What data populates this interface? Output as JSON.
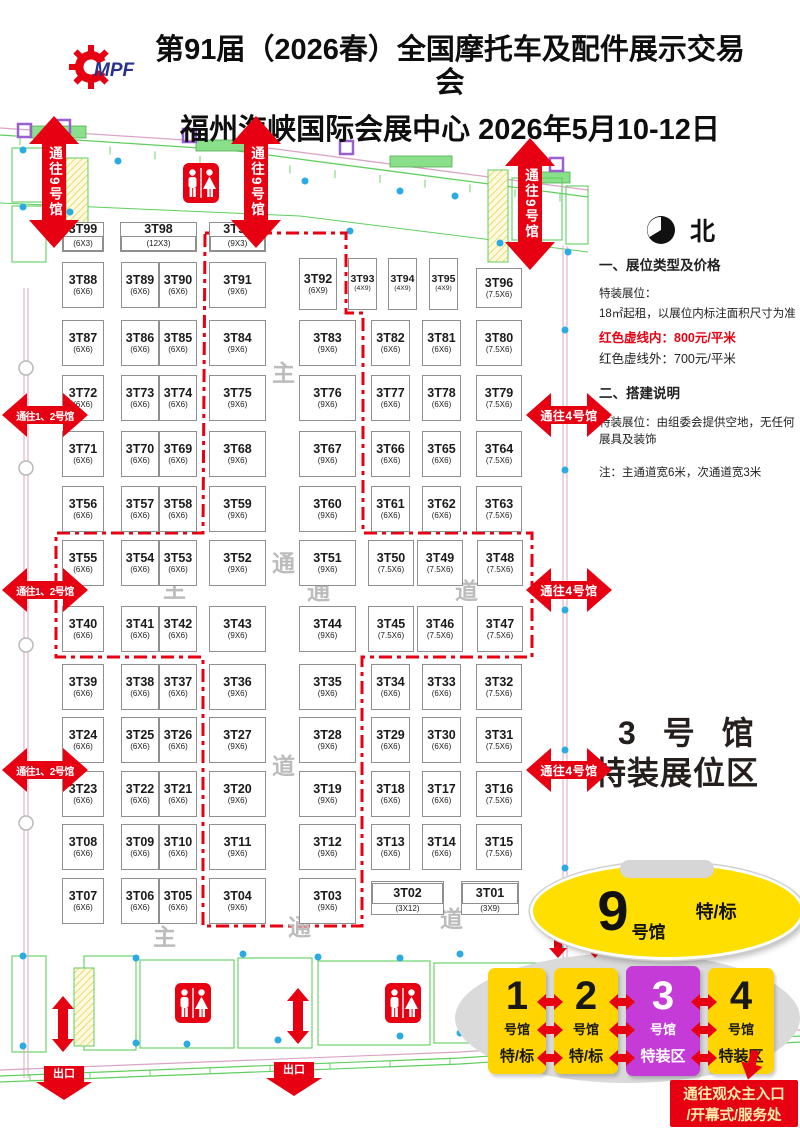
{
  "colors": {
    "red": "#e60012",
    "hall_yellow": "#ffd400",
    "hall_purple": "#c43bd8",
    "ellipse_yellow": "#ffdf00",
    "cad_green": "#5fcf5f",
    "cad_cyan": "#2aabe2",
    "logo_blue": "#28338a"
  },
  "header": {
    "logo_text": "MPF",
    "title_line1": "第91届（2026春）全国摩托车及配件展示交易会",
    "title_line2": "福州海峡国际会展中心  2026年5月10-12日"
  },
  "north": {
    "label": "北"
  },
  "info_panel": {
    "section1": "一、展位类型及价格",
    "l1": "特装展位：",
    "l2": "18㎡起租，以展位内标注面积尺寸为准",
    "l3": "红色虚线内：800元/平米",
    "l4": "红色虚线外：700元/平米",
    "section2": "二、搭建说明",
    "l5": "特装展位：由组委会提供空地，无任何展具及装饰",
    "note": "注：主通道宽6米，次通道宽3米"
  },
  "zone_label": {
    "line1": "3 号 馆",
    "line2": "特装展位区"
  },
  "arrows": {
    "top": {
      "label": "通往9号馆",
      "positions": [
        [
          29,
          116
        ],
        [
          231,
          116
        ],
        [
          505,
          138
        ]
      ]
    },
    "left": {
      "label": "通往1、2号馆",
      "positions": [
        [
          2,
          393
        ],
        [
          2,
          568
        ],
        [
          2,
          748
        ]
      ]
    },
    "right": {
      "label": "通往4号馆",
      "positions": [
        [
          526,
          393
        ],
        [
          526,
          568
        ],
        [
          526,
          748
        ]
      ]
    },
    "exits": {
      "label": "出口",
      "positions": [
        [
          36,
          1066
        ],
        [
          266,
          1062
        ]
      ]
    },
    "plain_vertical": [
      [
        52,
        996
      ],
      [
        287,
        988
      ]
    ]
  },
  "floor": {
    "premium_zone_path": "M205,233 L346,233 L346,313 L363,313 L363,533 L532,533 L532,657 L362,657 L362,926 L203,926 L203,657 L56,657 L56,533 L203,533 Z",
    "aisle_labels": [
      [
        "主",
        272,
        362
      ],
      [
        "通",
        272,
        552
      ],
      [
        "道",
        272,
        755
      ],
      [
        "主",
        163,
        578
      ],
      [
        "通",
        307,
        580
      ],
      [
        "道",
        455,
        580
      ],
      [
        "主",
        153,
        926
      ],
      [
        "通",
        288,
        916
      ],
      [
        "道",
        440,
        908
      ]
    ],
    "booths": [
      [
        "3T99",
        "(6X3)",
        62,
        222,
        42,
        30,
        1
      ],
      [
        "3T98",
        "(12X3)",
        120,
        222,
        77,
        30,
        1
      ],
      [
        "3T97",
        "(9X3)",
        209,
        222,
        57,
        30,
        1
      ],
      [
        "3T88",
        "(6X6)",
        62,
        262,
        42,
        46,
        0
      ],
      [
        "3T89",
        "(6X6)",
        121,
        262,
        38,
        46,
        0
      ],
      [
        "3T90",
        "(6X6)",
        159,
        262,
        38,
        46,
        0
      ],
      [
        "3T91",
        "(9X6)",
        209,
        262,
        57,
        46,
        0
      ],
      [
        "3T92",
        "(6X9)",
        299,
        258,
        38,
        52,
        0
      ],
      [
        "3T93",
        "(4X9)",
        348,
        258,
        29,
        52,
        0
      ],
      [
        "3T94",
        "(4X9)",
        388,
        258,
        29,
        52,
        0
      ],
      [
        "3T95",
        "(4X9)",
        429,
        258,
        29,
        52,
        0
      ],
      [
        "3T96",
        "(7.5X6)",
        476,
        268,
        46,
        40,
        0
      ],
      [
        "3T87",
        "(6X6)",
        62,
        320,
        42,
        46,
        0
      ],
      [
        "3T86",
        "(6X6)",
        121,
        320,
        38,
        46,
        0
      ],
      [
        "3T85",
        "(6X6)",
        159,
        320,
        38,
        46,
        0
      ],
      [
        "3T84",
        "(9X6)",
        209,
        320,
        57,
        46,
        0
      ],
      [
        "3T83",
        "(9X6)",
        299,
        320,
        57,
        46,
        0
      ],
      [
        "3T82",
        "(6X6)",
        371,
        320,
        39,
        46,
        0
      ],
      [
        "3T81",
        "(6X6)",
        422,
        320,
        39,
        46,
        0
      ],
      [
        "3T80",
        "(7.5X6)",
        476,
        320,
        46,
        46,
        0
      ],
      [
        "3T72",
        "(6X6)",
        62,
        375,
        42,
        46,
        0
      ],
      [
        "3T73",
        "(6X6)",
        121,
        375,
        38,
        46,
        0
      ],
      [
        "3T74",
        "(6X6)",
        159,
        375,
        38,
        46,
        0
      ],
      [
        "3T75",
        "(9X6)",
        209,
        375,
        57,
        46,
        0
      ],
      [
        "3T76",
        "(9X6)",
        299,
        375,
        57,
        46,
        0
      ],
      [
        "3T77",
        "(6X6)",
        371,
        375,
        39,
        46,
        0
      ],
      [
        "3T78",
        "(6X6)",
        422,
        375,
        39,
        46,
        0
      ],
      [
        "3T79",
        "(7.5X6)",
        476,
        375,
        46,
        46,
        0
      ],
      [
        "3T71",
        "(6X6)",
        62,
        431,
        42,
        46,
        0
      ],
      [
        "3T70",
        "(6X6)",
        121,
        431,
        38,
        46,
        0
      ],
      [
        "3T69",
        "(6X6)",
        159,
        431,
        38,
        46,
        0
      ],
      [
        "3T68",
        "(9X6)",
        209,
        431,
        57,
        46,
        0
      ],
      [
        "3T67",
        "(9X6)",
        299,
        431,
        57,
        46,
        0
      ],
      [
        "3T66",
        "(6X6)",
        371,
        431,
        39,
        46,
        0
      ],
      [
        "3T65",
        "(6X6)",
        422,
        431,
        39,
        46,
        0
      ],
      [
        "3T64",
        "(7.5X6)",
        476,
        431,
        46,
        46,
        0
      ],
      [
        "3T56",
        "(6X6)",
        62,
        486,
        42,
        46,
        0
      ],
      [
        "3T57",
        "(6X6)",
        121,
        486,
        38,
        46,
        0
      ],
      [
        "3T58",
        "(6X6)",
        159,
        486,
        38,
        46,
        0
      ],
      [
        "3T59",
        "(9X6)",
        209,
        486,
        57,
        46,
        0
      ],
      [
        "3T60",
        "(9X6)",
        299,
        486,
        57,
        46,
        0
      ],
      [
        "3T61",
        "(6X6)",
        371,
        486,
        39,
        46,
        0
      ],
      [
        "3T62",
        "(6X6)",
        422,
        486,
        39,
        46,
        0
      ],
      [
        "3T63",
        "(7.5X6)",
        476,
        486,
        46,
        46,
        0
      ],
      [
        "3T55",
        "(6X6)",
        62,
        540,
        42,
        46,
        0
      ],
      [
        "3T54",
        "(6X6)",
        121,
        540,
        38,
        46,
        0
      ],
      [
        "3T53",
        "(6X6)",
        159,
        540,
        38,
        46,
        0
      ],
      [
        "3T52",
        "(9X6)",
        209,
        540,
        57,
        46,
        0
      ],
      [
        "3T51",
        "(9X6)",
        299,
        540,
        57,
        46,
        0
      ],
      [
        "3T50",
        "(7.5X6)",
        368,
        540,
        46,
        46,
        0
      ],
      [
        "3T49",
        "(7.5X6)",
        417,
        540,
        46,
        46,
        0
      ],
      [
        "3T48",
        "(7.5X6)",
        477,
        540,
        46,
        46,
        0
      ],
      [
        "3T40",
        "(6X6)",
        62,
        606,
        42,
        46,
        0
      ],
      [
        "3T41",
        "(6X6)",
        121,
        606,
        38,
        46,
        0
      ],
      [
        "3T42",
        "(6X6)",
        159,
        606,
        38,
        46,
        0
      ],
      [
        "3T43",
        "(9X6)",
        209,
        606,
        57,
        46,
        0
      ],
      [
        "3T44",
        "(9X6)",
        299,
        606,
        57,
        46,
        0
      ],
      [
        "3T45",
        "(7.5X6)",
        368,
        606,
        46,
        46,
        0
      ],
      [
        "3T46",
        "(7.5X6)",
        417,
        606,
        46,
        46,
        0
      ],
      [
        "3T47",
        "(7.5X6)",
        477,
        606,
        46,
        46,
        0
      ],
      [
        "3T39",
        "(6X6)",
        62,
        664,
        42,
        46,
        0
      ],
      [
        "3T38",
        "(6X6)",
        121,
        664,
        38,
        46,
        0
      ],
      [
        "3T37",
        "(6X6)",
        159,
        664,
        38,
        46,
        0
      ],
      [
        "3T36",
        "(9X6)",
        209,
        664,
        57,
        46,
        0
      ],
      [
        "3T35",
        "(9X6)",
        299,
        664,
        57,
        46,
        0
      ],
      [
        "3T34",
        "(6X6)",
        371,
        664,
        39,
        46,
        0
      ],
      [
        "3T33",
        "(6X6)",
        422,
        664,
        39,
        46,
        0
      ],
      [
        "3T32",
        "(7.5X6)",
        476,
        664,
        46,
        46,
        0
      ],
      [
        "3T24",
        "(6X6)",
        62,
        717,
        42,
        46,
        0
      ],
      [
        "3T25",
        "(6X6)",
        121,
        717,
        38,
        46,
        0
      ],
      [
        "3T26",
        "(6X6)",
        159,
        717,
        38,
        46,
        0
      ],
      [
        "3T27",
        "(9X6)",
        209,
        717,
        57,
        46,
        0
      ],
      [
        "3T28",
        "(9X6)",
        299,
        717,
        57,
        46,
        0
      ],
      [
        "3T29",
        "(6X6)",
        371,
        717,
        39,
        46,
        0
      ],
      [
        "3T30",
        "(6X6)",
        422,
        717,
        39,
        46,
        0
      ],
      [
        "3T31",
        "(7.5X6)",
        476,
        717,
        46,
        46,
        0
      ],
      [
        "3T23",
        "(6X6)",
        62,
        771,
        42,
        46,
        0
      ],
      [
        "3T22",
        "(6X6)",
        121,
        771,
        38,
        46,
        0
      ],
      [
        "3T21",
        "(6X6)",
        159,
        771,
        38,
        46,
        0
      ],
      [
        "3T20",
        "(9X6)",
        209,
        771,
        57,
        46,
        0
      ],
      [
        "3T19",
        "(9X6)",
        299,
        771,
        57,
        46,
        0
      ],
      [
        "3T18",
        "(6X6)",
        371,
        771,
        39,
        46,
        0
      ],
      [
        "3T17",
        "(6X6)",
        422,
        771,
        39,
        46,
        0
      ],
      [
        "3T16",
        "(7.5X6)",
        476,
        771,
        46,
        46,
        0
      ],
      [
        "3T08",
        "(6X6)",
        62,
        824,
        42,
        46,
        0
      ],
      [
        "3T09",
        "(6X6)",
        121,
        824,
        38,
        46,
        0
      ],
      [
        "3T10",
        "(6X6)",
        159,
        824,
        38,
        46,
        0
      ],
      [
        "3T11",
        "(9X6)",
        209,
        824,
        57,
        46,
        0
      ],
      [
        "3T12",
        "(9X6)",
        299,
        824,
        57,
        46,
        0
      ],
      [
        "3T13",
        "(6X6)",
        371,
        824,
        39,
        46,
        0
      ],
      [
        "3T14",
        "(6X6)",
        422,
        824,
        39,
        46,
        0
      ],
      [
        "3T15",
        "(7.5X6)",
        476,
        824,
        46,
        46,
        0
      ],
      [
        "3T07",
        "(6X6)",
        62,
        878,
        42,
        46,
        0
      ],
      [
        "3T06",
        "(6X6)",
        121,
        878,
        38,
        46,
        0
      ],
      [
        "3T05",
        "(6X6)",
        159,
        878,
        38,
        46,
        0
      ],
      [
        "3T04",
        "(9X6)",
        209,
        878,
        57,
        46,
        0
      ],
      [
        "3T03",
        "(9X6)",
        299,
        878,
        57,
        46,
        0
      ],
      [
        "3T02",
        "(3X12)",
        371,
        881,
        73,
        21,
        2
      ],
      [
        "3T01",
        "(3X9)",
        461,
        881,
        58,
        21,
        2
      ]
    ]
  },
  "halls_diagram": {
    "hall9": {
      "number": "9",
      "suffix": "号馆",
      "tag": "特/标",
      "x": 530,
      "y": 862,
      "w": 268,
      "h": 92
    },
    "ellipse": {
      "x": 455,
      "y": 953,
      "w": 345,
      "h": 130
    },
    "halls": [
      {
        "number": "1",
        "suffix": "号馆",
        "tag": "特/标",
        "bg": "#ffd400",
        "fg": "#181818",
        "x": 488,
        "y": 968,
        "w": 58,
        "h": 106
      },
      {
        "number": "2",
        "suffix": "号馆",
        "tag": "特/标",
        "bg": "#ffd400",
        "fg": "#181818",
        "x": 554,
        "y": 968,
        "w": 64,
        "h": 106
      },
      {
        "number": "3",
        "suffix": "号馆",
        "tag": "特装区",
        "bg": "#c43bd8",
        "fg": "#ffffff",
        "x": 626,
        "y": 966,
        "w": 74,
        "h": 110
      },
      {
        "number": "4",
        "suffix": "号馆",
        "tag": "特装区",
        "bg": "#ffd400",
        "fg": "#181818",
        "x": 708,
        "y": 968,
        "w": 66,
        "h": 106
      }
    ],
    "v_connector_xs": [
      549,
      586,
      623,
      660,
      697
    ],
    "v_connector_y": 928,
    "h_connector_centers": [
      550,
      622,
      704
    ],
    "h_connector_ys": [
      994,
      1022,
      1050
    ],
    "down_arrow": {
      "x": 740,
      "y": 1050
    },
    "entrance": {
      "line1": "通往观众主入口",
      "line2": "/开幕式/服务处"
    }
  },
  "toilets": [
    [
      183,
      163
    ],
    [
      175,
      983
    ],
    [
      385,
      983
    ]
  ]
}
